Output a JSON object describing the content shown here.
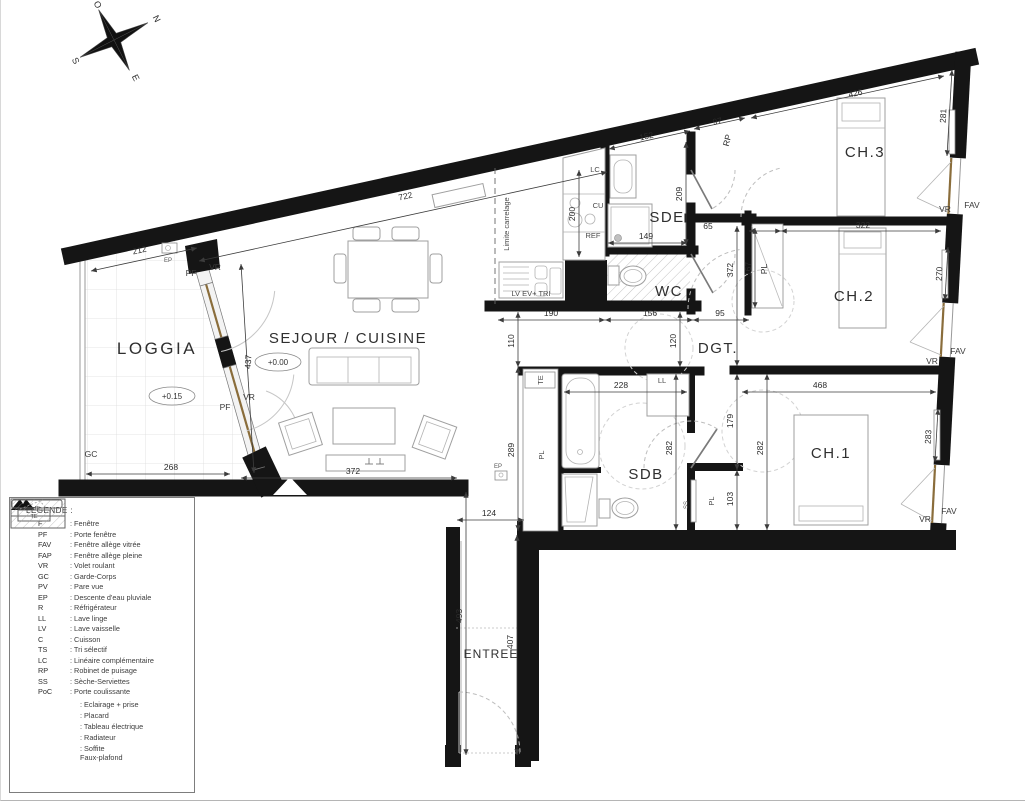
{
  "compass": {
    "n": "N",
    "e": "E",
    "s": "S",
    "o": "O"
  },
  "rooms": {
    "loggia": "LOGGIA",
    "sejour": "SEJOUR / CUISINE",
    "sde": "SDE",
    "wc": "WC",
    "dgt": "DGT.",
    "ch1": "CH.1",
    "ch2": "CH.2",
    "ch3": "CH.3",
    "sdb": "SDB",
    "entree": "ENTREE"
  },
  "levels": {
    "loggia": "+0.15",
    "sejour": "+0.00"
  },
  "dims": {
    "d212": "212",
    "d268": "268",
    "d437": "437",
    "d722": "722",
    "d372_sejour": "372",
    "d110": "110",
    "d289": "289",
    "d190": "190",
    "d156": "156",
    "d95": "95",
    "d120": "120",
    "d152": "152",
    "d200": "200",
    "d209": "209",
    "d149": "149",
    "d97": "97",
    "d426": "426",
    "d281": "281",
    "d65": "65",
    "d322": "322",
    "d372_dgt": "372",
    "d167": "167",
    "d270": "270",
    "d468": "468",
    "d179": "179",
    "d282_sdb": "282",
    "d282_ch1": "282",
    "d103": "103",
    "d283": "283",
    "d228": "228",
    "d124": "124",
    "d493": "493",
    "d407": "407"
  },
  "tags": {
    "pf": "PF",
    "vr": "VR",
    "fav": "FAV",
    "gc": "GC",
    "ep": "EP",
    "rp": "RP",
    "lc": "LC",
    "cu": "CU",
    "ref": "REF",
    "lv_ev_tri": "LV  EV+ TRI",
    "ll": "LL",
    "te": "TE",
    "pl": "PL",
    "ss": "SS",
    "limite_carrelage": "Limite carrelage"
  },
  "legend": {
    "title": "LEGENDE :",
    "items": [
      {
        "abbr": "F",
        "label": ": Fenêtre"
      },
      {
        "abbr": "PF",
        "label": ": Porte fenêtre"
      },
      {
        "abbr": "FAV",
        "label": ": Fenêtre allège vitrée"
      },
      {
        "abbr": "FAP",
        "label": ": Fenêtre allège pleine"
      },
      {
        "abbr": "VR",
        "label": ": Volet roulant"
      },
      {
        "abbr": "GC",
        "label": ": Garde-Corps"
      },
      {
        "abbr": "PV",
        "label": ": Pare vue"
      },
      {
        "abbr": "EP",
        "label": ": Descente d'eau pluviale"
      },
      {
        "abbr": "R",
        "label": ": Réfrigérateur"
      },
      {
        "abbr": "LL",
        "label": ": Lave linge"
      },
      {
        "abbr": "LV",
        "label": ": Lave vaisselle"
      },
      {
        "abbr": "C",
        "label": ": Cuisson"
      },
      {
        "abbr": "TS",
        "label": ": Tri sélectif"
      },
      {
        "abbr": "LC",
        "label": ": Linéaire complémentaire"
      },
      {
        "abbr": "RP",
        "label": ": Robinet de puisage"
      },
      {
        "abbr": "SS",
        "label": ": Sèche-Serviettes"
      },
      {
        "abbr": "PoC",
        "label": ": Porte coulissante"
      }
    ],
    "symbols": {
      "eclairage": {
        "label": ": Eclairage + prise"
      },
      "placard": {
        "swatch": "PL",
        "label": ": Placard"
      },
      "tableau": {
        "swatch": "TE",
        "label": ": Tableau électrique"
      },
      "radiateur": {
        "label": ": Radiateur"
      },
      "soffite": {
        "label": ": Soffite",
        "label2": "Faux-plafond"
      }
    }
  }
}
